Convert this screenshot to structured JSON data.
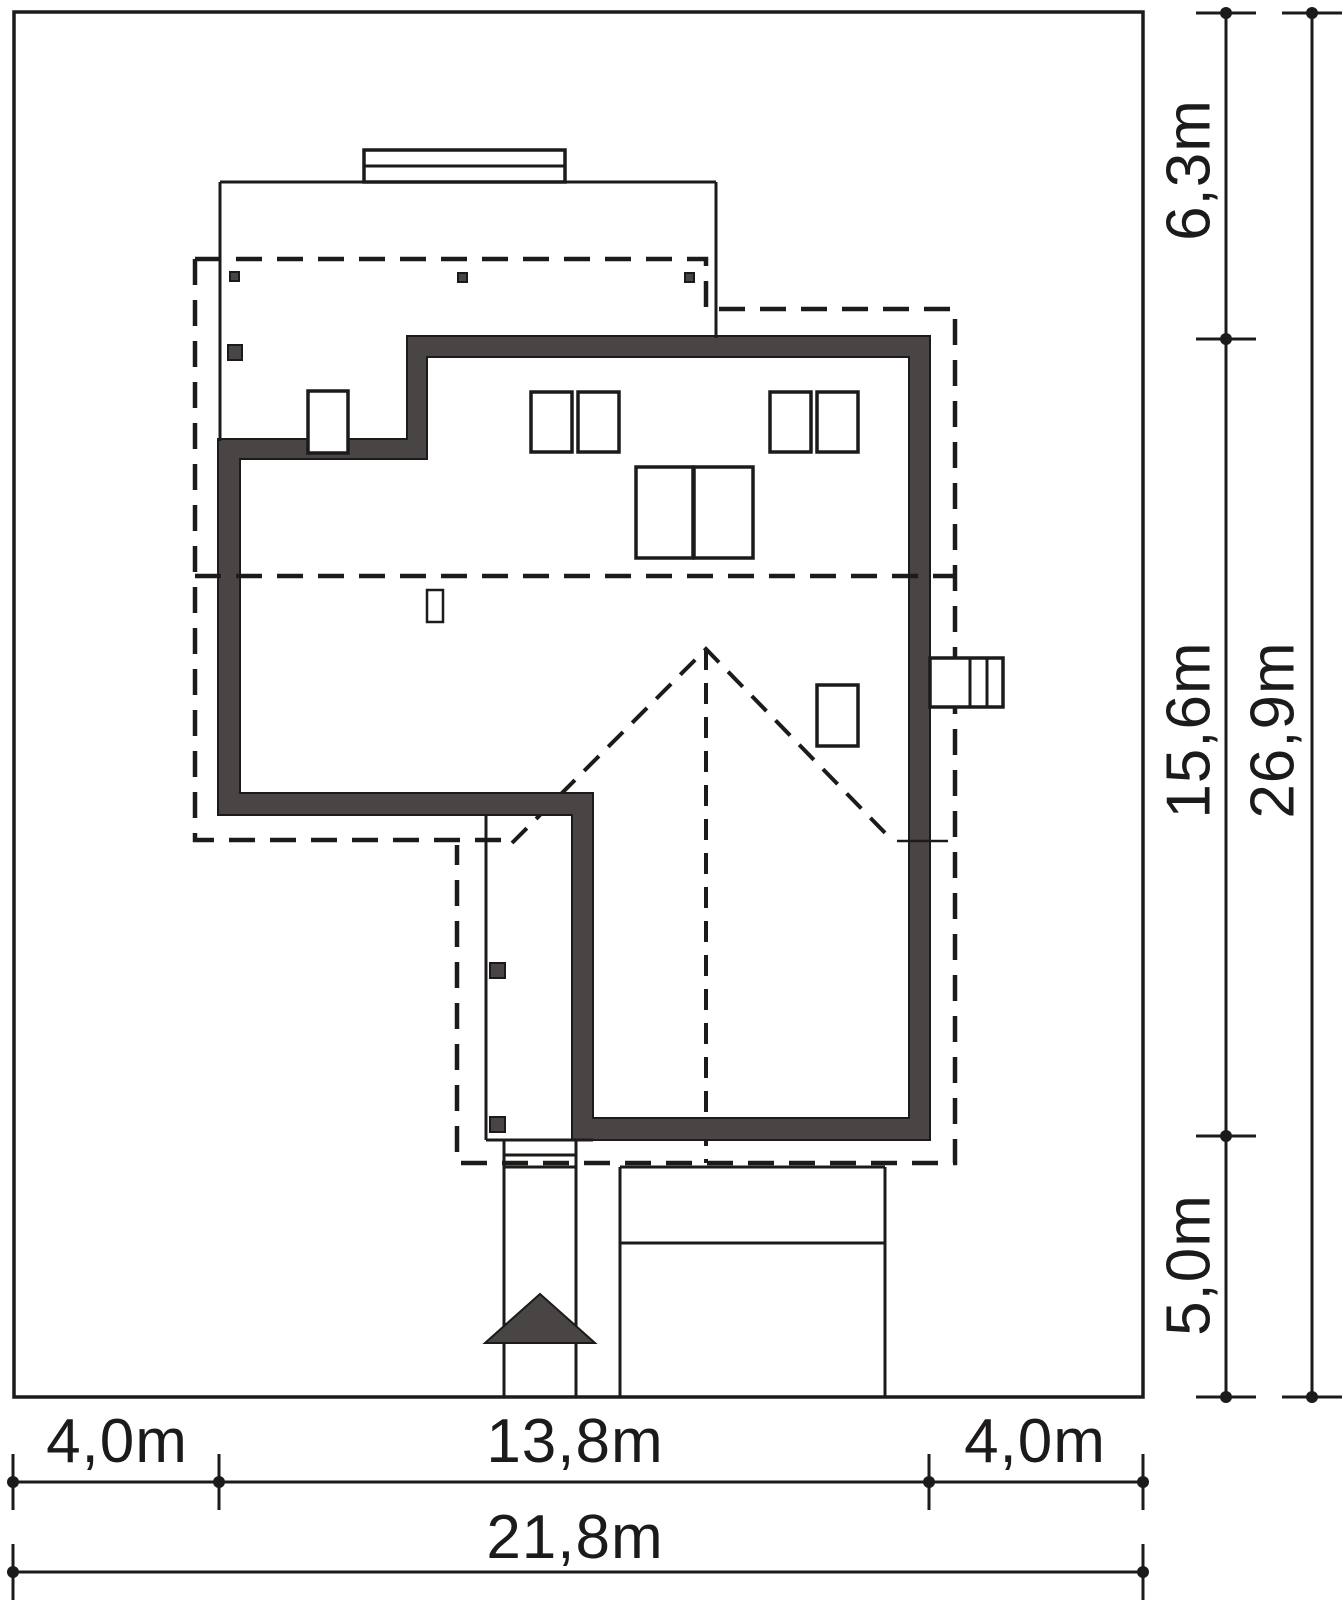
{
  "colors": {
    "wall": "#4a4545"
  },
  "dims": {
    "right": [
      {
        "label": "6,3m"
      },
      {
        "label": "15,6m"
      },
      {
        "label": "5,0m"
      },
      {
        "label": "26,9m"
      }
    ],
    "bottom": [
      {
        "label": "4,0m"
      },
      {
        "label": "13,8m"
      },
      {
        "label": "4,0m"
      },
      {
        "label": "21,8m"
      }
    ]
  }
}
